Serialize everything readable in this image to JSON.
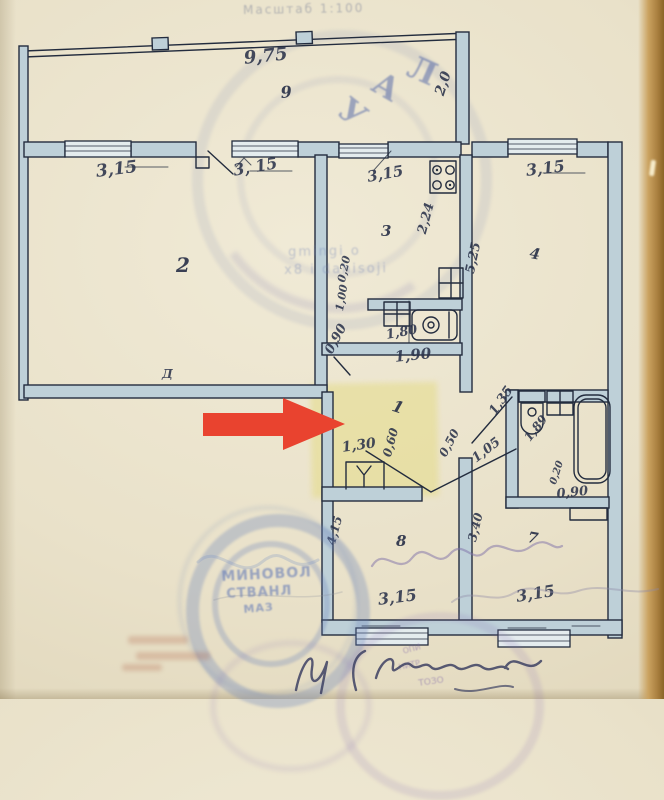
{
  "colors": {
    "ink": "#232c3e",
    "wall_fill": "#bed0d8",
    "window_fill": "#e4ecee",
    "arrow_red": "#e9432f",
    "highlight_yellow": "#e5db82",
    "stamp_blue": "#4a5fa5"
  },
  "scale_note": "Масштаб 1:100",
  "marker": {
    "type": "arrow",
    "direction": "right",
    "points_to_room": "1"
  },
  "plan": {
    "room_labels": [
      {
        "text": "9",
        "x": 280,
        "y": 85,
        "size": 16,
        "rot": -5
      },
      {
        "text": "2",
        "x": 176,
        "y": 255,
        "size": 20,
        "rot": 0
      },
      {
        "text": "3",
        "x": 381,
        "y": 224,
        "size": 15,
        "rot": 0
      },
      {
        "text": "4",
        "x": 531,
        "y": 246,
        "size": 15,
        "rot": 10
      },
      {
        "text": "1",
        "x": 395,
        "y": 398,
        "size": 16,
        "rot": 18
      },
      {
        "text": "8",
        "x": 396,
        "y": 534,
        "size": 15,
        "rot": 0
      },
      {
        "text": "7",
        "x": 529,
        "y": 530,
        "size": 15,
        "rot": 10
      }
    ],
    "dimension_labels": [
      {
        "text": "9,75",
        "x": 243,
        "y": 50,
        "rot": -6,
        "size": 18
      },
      {
        "text": "2,0",
        "x": 433,
        "y": 93,
        "rot": -72,
        "size": 14
      },
      {
        "text": "3,15",
        "x": 95,
        "y": 164,
        "rot": -7,
        "size": 17
      },
      {
        "text": "3, 15",
        "x": 232,
        "y": 163,
        "rot": -10,
        "size": 16
      },
      {
        "text": "3,15",
        "x": 366,
        "y": 170,
        "rot": -10,
        "size": 15
      },
      {
        "text": "3,15",
        "x": 525,
        "y": 163,
        "rot": -7,
        "size": 16
      },
      {
        "text": "2,24",
        "x": 416,
        "y": 232,
        "rot": -75,
        "size": 13
      },
      {
        "text": "5,25",
        "x": 464,
        "y": 272,
        "rot": -78,
        "size": 13
      },
      {
        "text": "1,80",
        "x": 385,
        "y": 329,
        "rot": -10,
        "size": 13
      },
      {
        "text": "1,90",
        "x": 394,
        "y": 350,
        "rot": -6,
        "size": 15
      },
      {
        "text": "0,90",
        "x": 323,
        "y": 350,
        "rot": -62,
        "size": 13
      },
      {
        "text": "0,20",
        "x": 336,
        "y": 281,
        "rot": -78,
        "size": 11
      },
      {
        "text": "1,00",
        "x": 334,
        "y": 310,
        "rot": -80,
        "size": 11
      },
      {
        "text": "1,30",
        "x": 341,
        "y": 441,
        "rot": -8,
        "size": 14
      },
      {
        "text": "0,60",
        "x": 381,
        "y": 455,
        "rot": -75,
        "size": 12
      },
      {
        "text": "0,50",
        "x": 437,
        "y": 453,
        "rot": -62,
        "size": 12
      },
      {
        "text": "1,05",
        "x": 470,
        "y": 455,
        "rot": -38,
        "size": 13
      },
      {
        "text": "1,35",
        "x": 487,
        "y": 410,
        "rot": -55,
        "size": 13
      },
      {
        "text": "1,89",
        "x": 522,
        "y": 436,
        "rot": -52,
        "size": 12
      },
      {
        "text": "0,20",
        "x": 549,
        "y": 483,
        "rot": -72,
        "size": 10
      },
      {
        "text": "0,90",
        "x": 556,
        "y": 488,
        "rot": -6,
        "size": 13
      },
      {
        "text": "3,40",
        "x": 466,
        "y": 540,
        "rot": -76,
        "size": 12
      },
      {
        "text": "4,15",
        "x": 325,
        "y": 543,
        "rot": -75,
        "size": 12
      },
      {
        "text": "3,15",
        "x": 377,
        "y": 592,
        "rot": -7,
        "size": 16
      },
      {
        "text": "3,15",
        "x": 515,
        "y": 589,
        "rot": -9,
        "size": 16
      },
      {
        "text": "Д",
        "x": 162,
        "y": 368,
        "rot": 0,
        "size": 12
      }
    ]
  },
  "stamps": {
    "top_letters": [
      {
        "text": "У",
        "x": 352,
        "y": 92,
        "rot": 38,
        "size": 32
      },
      {
        "text": "А",
        "x": 383,
        "y": 66,
        "rot": 30,
        "size": 32
      },
      {
        "text": "Л",
        "x": 416,
        "y": 50,
        "rot": 24,
        "size": 32
      }
    ],
    "bleed_lines": [
      {
        "text": "gmingi o",
        "x": 288,
        "y": 246,
        "rot": -1,
        "size": 13
      },
      {
        "text": "x8 i dahisoji",
        "x": 284,
        "y": 264,
        "rot": -1,
        "size": 13
      }
    ],
    "round_stamp_lines": [
      {
        "text": "МИНОВОЛ",
        "x": 221,
        "y": 570,
        "rot": -3,
        "size": 14
      },
      {
        "text": "СТВАНЛ",
        "x": 226,
        "y": 588,
        "rot": -3,
        "size": 13
      },
      {
        "text": "МАЗ",
        "x": 243,
        "y": 604,
        "rot": -5,
        "size": 11
      }
    ],
    "purple_fragments": [
      {
        "text": "ОПИ",
        "x": 402,
        "y": 648,
        "rot": -15,
        "size": 8
      },
      {
        "text": "НИТР",
        "x": 398,
        "y": 664,
        "rot": -12,
        "size": 8
      },
      {
        "text": "ТОЗО",
        "x": 418,
        "y": 680,
        "rot": -8,
        "size": 9
      }
    ]
  }
}
